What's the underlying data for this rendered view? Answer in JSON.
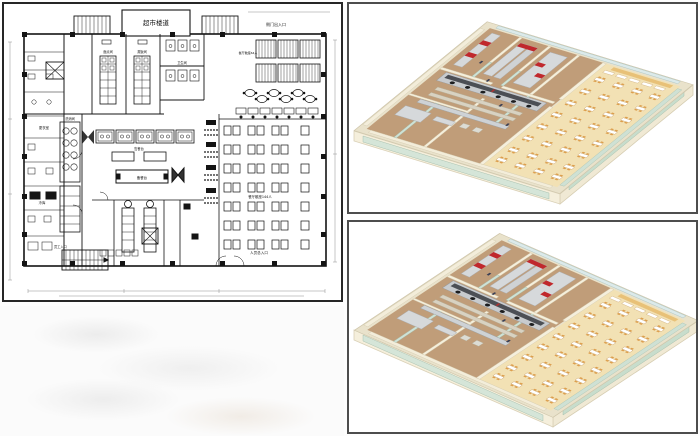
{
  "floor_plan": {
    "title_block": "超市楼道",
    "labels": {
      "side_entrance": "侧门出入口",
      "staff_dining_seats": "餐厅散座64人",
      "main_dining_seats": "餐厅散座144人",
      "serving_counter": "售餐台",
      "prep_counter": "备餐台",
      "pastry_room": "面点间",
      "steam_rice_room": "蒸饭间",
      "washroom": "卫生间",
      "sanitize_room": "洗消间",
      "cold_storage": "冷库",
      "changing_room": "更衣室",
      "staff_entrance": "员工入口",
      "main_entrance": "人员总入口"
    },
    "colors": {
      "line": "#141414",
      "dim_line": "#8f8f8f",
      "paper": "#ffffff"
    }
  },
  "renders": {
    "colors": {
      "wall_top": "#e9e2cb",
      "wall_face": "#f3edda",
      "kitchen_floor": "#c09d79",
      "dining_floor": "#f2e1b4",
      "glass_partition": "#cfe2d6",
      "window_band": "#dceaea",
      "stainless": "#d6d9db",
      "hood_dark": "#4c4f55",
      "burner": "#1c1d1f",
      "red_equipment": "#c0282c",
      "table_top": "#ffffff",
      "chair": "#dd9f4e",
      "long_table": "#e8c178",
      "shelf": "#d8d2c2"
    }
  }
}
